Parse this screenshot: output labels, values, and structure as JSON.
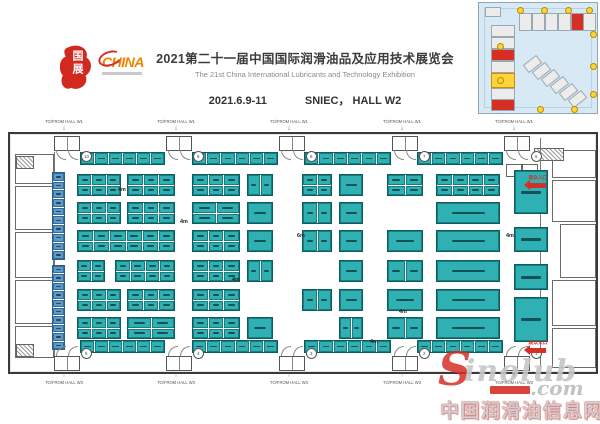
{
  "colors": {
    "booth_teal": "#2fb1b3",
    "booth_blue": "#5b9bc8",
    "accent_red": "#d62f26",
    "orange": "#f08300",
    "yellow": "#ffd43b"
  },
  "header": {
    "title_cn": "2021第二十一届中国国际润滑油品及应用技术展览会",
    "title_en": "The 21st China International Lubricants and Technology Exhibition",
    "date": "2021.6.9-11",
    "venue": "SNIEC，  HALL W2"
  },
  "logo": {
    "seal_text": "国展",
    "brand": "CHINA"
  },
  "plan": {
    "top_link_label": "TO/FROM HALL W1",
    "bottom_link_label": "TO/FROM HALL W3",
    "arrow_down": "↓",
    "arrow_up": "↑",
    "entrance_label": "观众入口",
    "crossings_x": [
      64,
      176,
      289,
      402,
      514
    ],
    "doors_x": [
      56,
      168,
      281,
      394,
      506
    ],
    "gates_top": [
      "10",
      "9",
      "8",
      "7",
      "6"
    ],
    "gates_bottom": [
      "5",
      "4",
      "3",
      "2",
      "1"
    ],
    "aisle_labels": [
      {
        "t": "4m",
        "x": 108,
        "y": 52
      },
      {
        "t": "4m",
        "x": 170,
        "y": 84
      },
      {
        "t": "6m",
        "x": 287,
        "y": 98
      },
      {
        "t": "4m",
        "x": 222,
        "y": 142
      },
      {
        "t": "4m",
        "x": 389,
        "y": 174
      },
      {
        "t": "4m",
        "x": 496,
        "y": 98
      },
      {
        "t": "4m",
        "x": 360,
        "y": 204
      }
    ],
    "strips_top": [
      [
        70,
        18,
        85,
        13
      ],
      [
        182,
        18,
        86,
        13
      ],
      [
        294,
        18,
        87,
        13
      ],
      [
        407,
        18,
        86,
        13
      ]
    ],
    "strips_bottom": [
      [
        70,
        206,
        85,
        13
      ],
      [
        182,
        206,
        86,
        13
      ],
      [
        294,
        206,
        87,
        13
      ],
      [
        407,
        206,
        86,
        13
      ]
    ],
    "left_columns": [
      [
        42,
        38,
        13,
        88
      ],
      [
        42,
        131,
        13,
        85
      ]
    ],
    "blocks": [
      [
        67,
        40,
        44,
        22,
        3,
        2
      ],
      [
        117,
        40,
        48,
        22,
        3,
        2
      ],
      [
        182,
        40,
        48,
        22,
        3,
        2
      ],
      [
        237,
        40,
        26,
        22,
        2,
        1
      ],
      [
        292,
        40,
        30,
        22,
        2,
        2
      ],
      [
        329,
        40,
        24,
        22,
        1,
        1
      ],
      [
        377,
        40,
        36,
        22,
        2,
        2
      ],
      [
        426,
        40,
        64,
        22,
        4,
        2
      ],
      [
        67,
        68,
        44,
        22,
        3,
        2
      ],
      [
        117,
        68,
        48,
        22,
        3,
        2
      ],
      [
        182,
        68,
        48,
        22,
        2,
        2
      ],
      [
        237,
        68,
        26,
        22,
        1,
        1
      ],
      [
        292,
        68,
        30,
        22,
        2,
        1
      ],
      [
        329,
        68,
        24,
        22,
        1,
        1
      ],
      [
        426,
        68,
        64,
        22,
        1,
        1
      ],
      [
        67,
        96,
        98,
        22,
        6,
        2
      ],
      [
        182,
        96,
        48,
        22,
        3,
        2
      ],
      [
        237,
        96,
        26,
        22,
        1,
        1
      ],
      [
        292,
        96,
        30,
        22,
        2,
        1
      ],
      [
        329,
        96,
        24,
        22,
        1,
        1
      ],
      [
        377,
        96,
        36,
        22,
        1,
        1
      ],
      [
        426,
        96,
        64,
        22,
        1,
        1
      ],
      [
        67,
        126,
        28,
        22,
        2,
        2
      ],
      [
        105,
        126,
        60,
        22,
        4,
        2
      ],
      [
        182,
        126,
        48,
        22,
        3,
        2
      ],
      [
        237,
        126,
        26,
        22,
        2,
        1
      ],
      [
        329,
        126,
        24,
        22,
        1,
        1
      ],
      [
        377,
        126,
        36,
        22,
        2,
        1
      ],
      [
        426,
        126,
        64,
        22,
        1,
        1
      ],
      [
        67,
        155,
        44,
        22,
        3,
        2
      ],
      [
        117,
        155,
        48,
        22,
        3,
        2
      ],
      [
        182,
        155,
        48,
        22,
        3,
        2
      ],
      [
        292,
        155,
        30,
        22,
        2,
        1
      ],
      [
        329,
        155,
        24,
        22,
        1,
        1
      ],
      [
        377,
        155,
        36,
        22,
        1,
        1
      ],
      [
        426,
        155,
        64,
        22,
        1,
        1
      ],
      [
        67,
        183,
        44,
        22,
        3,
        2
      ],
      [
        117,
        183,
        48,
        22,
        2,
        2
      ],
      [
        182,
        183,
        48,
        22,
        3,
        2
      ],
      [
        237,
        183,
        26,
        22,
        1,
        1
      ],
      [
        329,
        183,
        24,
        22,
        2,
        1
      ],
      [
        377,
        183,
        36,
        22,
        2,
        1
      ],
      [
        426,
        183,
        64,
        22,
        1,
        1
      ]
    ],
    "right_blocks": [
      [
        504,
        36,
        34,
        44
      ],
      [
        504,
        93,
        34,
        25
      ],
      [
        504,
        130,
        34,
        26
      ],
      [
        504,
        163,
        34,
        45
      ]
    ],
    "rooms_left": [
      [
        5,
        20,
        37,
        28
      ],
      [
        5,
        52,
        37,
        42
      ],
      [
        5,
        98,
        37,
        44
      ],
      [
        5,
        146,
        37,
        42
      ],
      [
        5,
        192,
        37,
        30
      ]
    ],
    "rooms_right": [
      [
        542,
        16,
        42,
        26
      ],
      [
        542,
        46,
        42,
        40
      ],
      [
        550,
        90,
        34,
        52
      ],
      [
        542,
        146,
        42,
        44
      ],
      [
        542,
        194,
        42,
        38
      ]
    ],
    "hatches": [
      [
        6,
        22,
        16,
        11
      ],
      [
        6,
        210,
        16,
        11
      ],
      [
        524,
        14,
        28,
        11
      ]
    ],
    "service_boxes": [
      [
        496,
        30,
        14,
        11
      ],
      [
        512,
        30,
        14,
        11
      ]
    ],
    "walls": [
      [
        44,
        18,
        1,
        208
      ],
      [
        530,
        4,
        1,
        232
      ]
    ],
    "arrows": [
      {
        "x": 505,
        "y": 38
      },
      {
        "x": 505,
        "y": 203
      }
    ]
  },
  "inset": {
    "left_halls": [
      {
        "y": 22,
        "c": "gray"
      },
      {
        "y": 34,
        "c": "gray"
      },
      {
        "y": 46,
        "c": "red"
      },
      {
        "y": 58,
        "c": "gray"
      },
      {
        "y": 70,
        "c": "yellow"
      },
      {
        "y": 85,
        "c": "gray"
      },
      {
        "y": 96,
        "c": "red"
      }
    ],
    "top_halls": [
      {
        "x": 40,
        "c": "gray"
      },
      {
        "x": 53,
        "c": "gray"
      },
      {
        "x": 66,
        "c": "gray"
      },
      {
        "x": 79,
        "c": "gray"
      },
      {
        "x": 92,
        "c": "red"
      },
      {
        "x": 104,
        "c": "gray"
      }
    ],
    "diag_halls": [
      {
        "x": 45,
        "y": 56
      },
      {
        "x": 54,
        "y": 63
      },
      {
        "x": 63,
        "y": 70
      },
      {
        "x": 72,
        "y": 77
      },
      {
        "x": 81,
        "y": 84
      },
      {
        "x": 90,
        "y": 91
      }
    ],
    "dots": [
      [
        38,
        4
      ],
      [
        62,
        4
      ],
      [
        86,
        4
      ],
      [
        107,
        4
      ],
      [
        111,
        28
      ],
      [
        111,
        60
      ],
      [
        111,
        88
      ],
      [
        18,
        40
      ],
      [
        18,
        74
      ],
      [
        58,
        103
      ],
      [
        92,
        103
      ]
    ]
  },
  "watermark": {
    "s": "S",
    "name": "inolub",
    "tld": ".com",
    "cn": "中国润滑油信息网"
  }
}
